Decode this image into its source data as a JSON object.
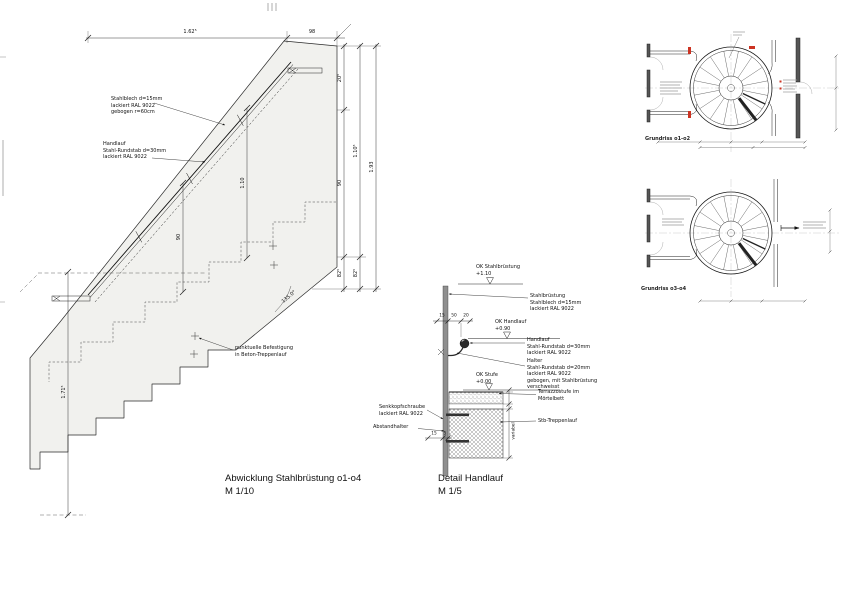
{
  "colors": {
    "accent_red": "#cc3322",
    "surface_gray": "#f1f1ee",
    "line": "#1a1a1a"
  },
  "drawing": {
    "abwicklung": {
      "title": "Abwicklung Stahlbrüstung o1-o4",
      "scale": "M 1/10",
      "label_plate": "Stahlblech d=15mm\nlackiert RAL 9022\ngebogen r=60cm",
      "label_handrail": "Handlauf\nStahl-Rundstab d=30mm\nlackiert RAL 9022",
      "label_fixing": "punktuelle Befestigung\nin Beton-Treppenlauf",
      "dim_top_1": "1.62⁵",
      "dim_top_2": "98",
      "dim_right_1": "20⁵",
      "dim_right_2": "90",
      "dim_right_3": "82⁵",
      "dim_right_4": "1.10⁵",
      "dim_right_5": "82⁵",
      "dim_right_6": "1.93",
      "dim_left": "1.71⁵",
      "dim_inner_1": "1.10",
      "dim_inner_2": "90",
      "angle": "135.0°"
    },
    "detail": {
      "title": "Detail Handlauf",
      "scale": "M 1/5",
      "level_1_name": "OK Stahlbrüstung",
      "level_1_value": "+1.10",
      "level_2_name": "OK Handlauf",
      "level_2_value": "+0.90",
      "level_3_name": "OK Stufe",
      "level_3_value": "+0.00",
      "label_bruestung": "Stahlbrüstung\nStahlblech d=15mm\nlackiert RAL 9022",
      "label_handlauf": "Handlauf\nStahl-Rundstab d=30mm\nlackiert RAL 9022",
      "label_halter": "Halter\nStahl-Rundstab d=20mm\nlackiert RAL 9022\ngebogen, mit Stahlbrüstung\nverschweisst",
      "label_terrazzo": "Terrazzostufe im\nMörtelbett",
      "label_stb": "Stb-Treppenlauf",
      "label_schraube": "Senkkopfschraube\nlackiert RAL 9022",
      "label_abstandhalter": "Abstandhalter",
      "dim_1": "15",
      "dim_2": "50",
      "dim_3": "20",
      "dim_4": "15",
      "dim_5": "5",
      "dim_var": "variabel"
    },
    "plans": {
      "caption_top": "Grundriss o1-o2",
      "caption_bottom": "Grundriss o3-o4"
    }
  }
}
